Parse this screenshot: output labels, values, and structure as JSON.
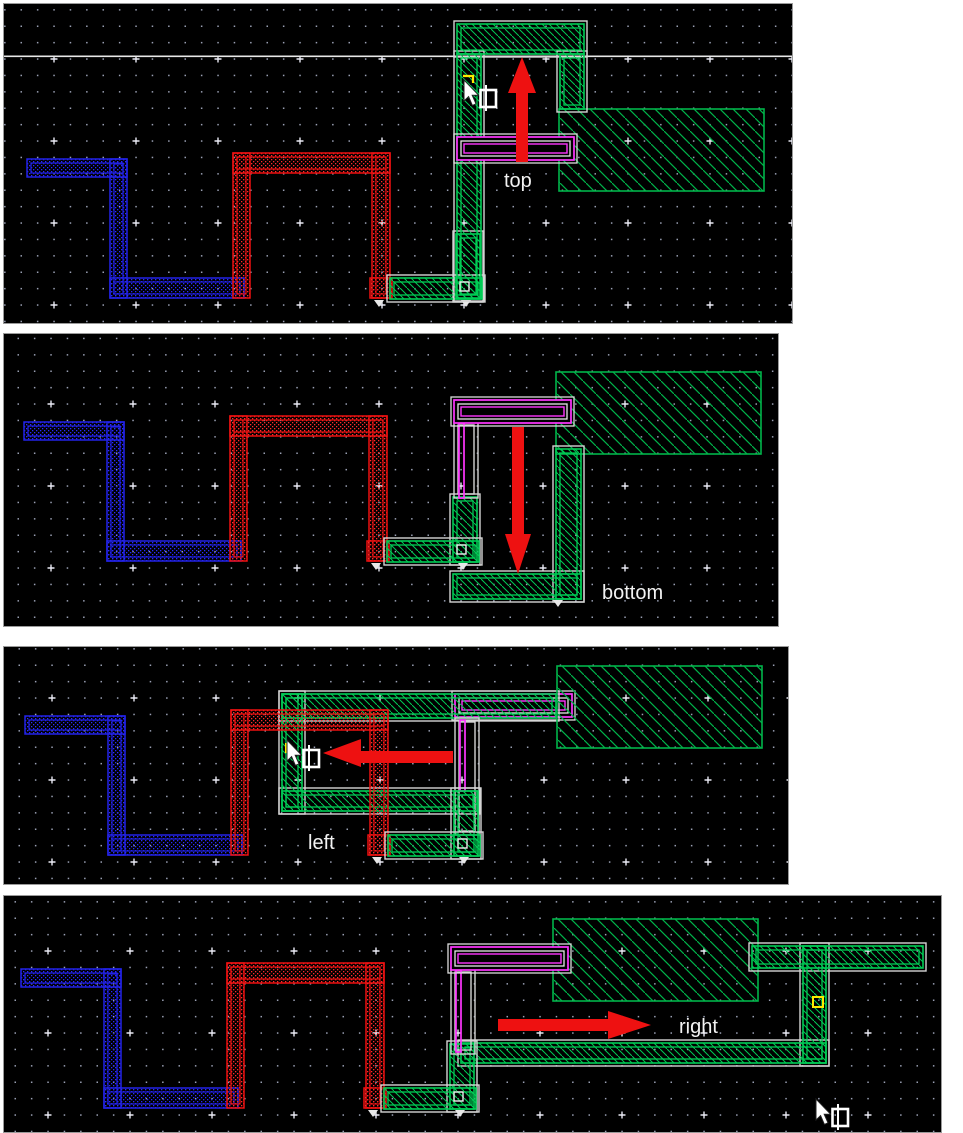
{
  "panels": [
    {
      "id": "top",
      "label": "top"
    },
    {
      "id": "bottom",
      "label": "bottom"
    },
    {
      "id": "left",
      "label": "left"
    },
    {
      "id": "right",
      "label": "right"
    }
  ],
  "colors": {
    "canvas_bg": "#000000",
    "grid_dot": "#9aa0b4",
    "grid_plus": "#e8e8f2",
    "wire_blue": "#2222e8",
    "wire_red": "#ee1111",
    "wire_green": "#00cc55",
    "big_rect_green": "#00b44a",
    "wire_magenta": "#ff35ff",
    "selection_outline": "#d4d4d4",
    "arrow_red": "#ee1111",
    "label_text": "#f2f2f2",
    "marker_yellow": "#ffe800"
  },
  "icons": [
    {
      "name": "cursor-pointer-icon",
      "glyph": "arrow-pointer"
    },
    {
      "name": "stretch-box-cursor-icon",
      "glyph": "open-box-with-bar"
    },
    {
      "name": "partial-select-marker-icon",
      "glyph": "yellow-corner"
    }
  ]
}
